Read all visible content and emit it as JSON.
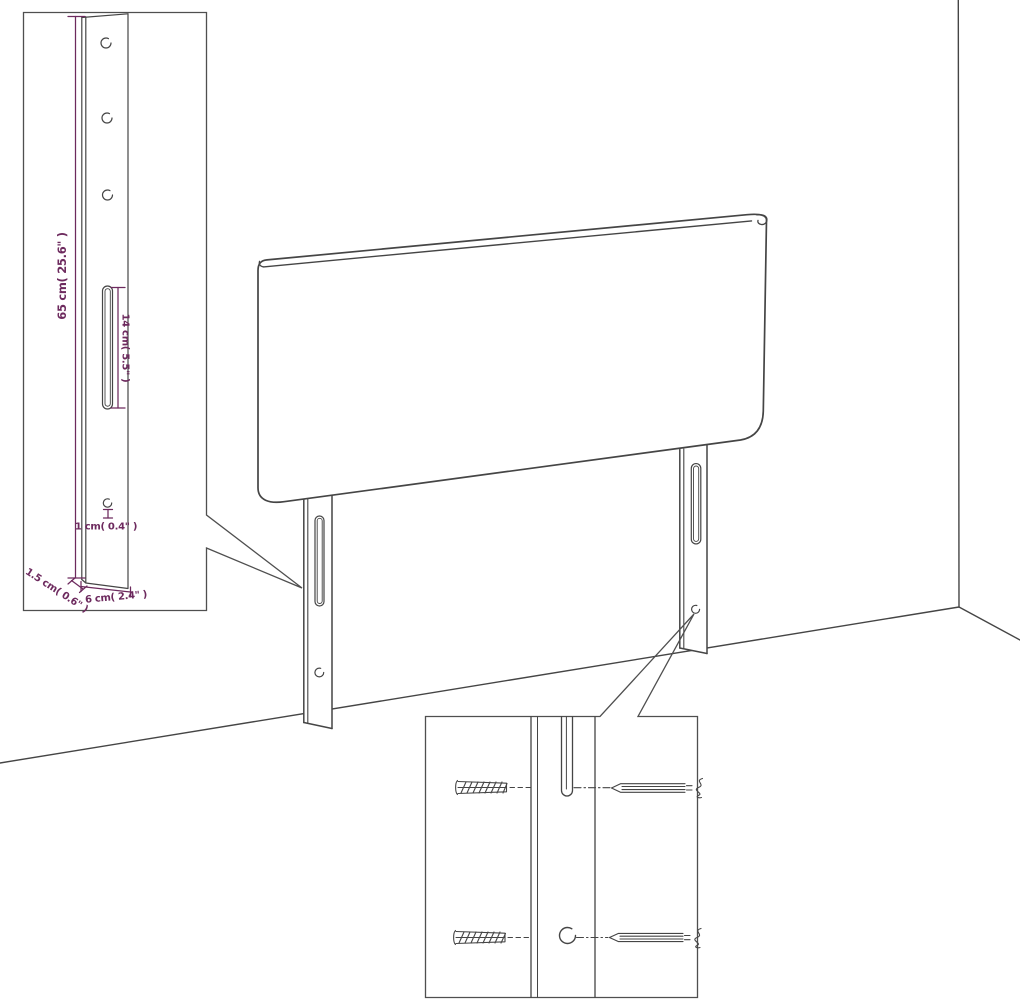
{
  "colors": {
    "line": "#454545",
    "dimension_text": "#6d2a5e",
    "inset_border": "#4f4f4f",
    "background": "#ffffff"
  },
  "leg_detail_inset": {
    "height_label": "65 cm( 25.6\" )",
    "slot_label": "14 cm( 5.5\" )",
    "hole_label": "1 cm( 0.4\" )",
    "thickness_label": "1.5 cm( 0.6\" )",
    "width_label": "6 cm( 2.4\" )"
  }
}
